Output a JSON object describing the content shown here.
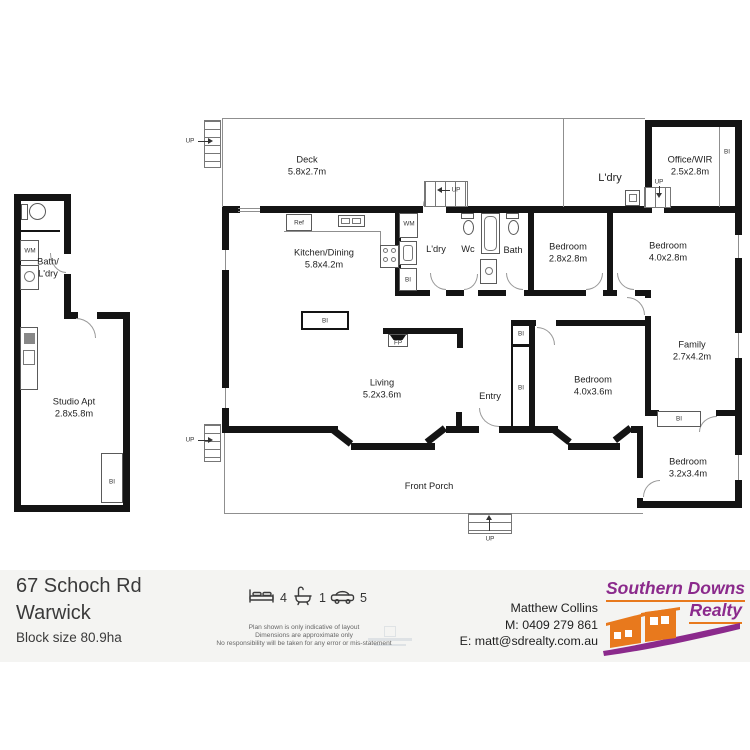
{
  "plan": {
    "rooms": {
      "deck": {
        "name": "Deck",
        "dims": "5.8x2.7m"
      },
      "ldry_top": {
        "name": "L'dry"
      },
      "office": {
        "name": "Office/WIR",
        "dims": "2.5x2.8m"
      },
      "kitchen": {
        "name": "Kitchen/Dining",
        "dims": "5.8x4.2m"
      },
      "ldry": {
        "name": "L'dry"
      },
      "wc": {
        "name": "Wc"
      },
      "bath": {
        "name": "Bath"
      },
      "bed1": {
        "name": "Bedroom",
        "dims": "2.8x2.8m"
      },
      "bed2": {
        "name": "Bedroom",
        "dims": "4.0x2.8m"
      },
      "living": {
        "name": "Living",
        "dims": "5.2x3.6m"
      },
      "entry": {
        "name": "Entry"
      },
      "bed3": {
        "name": "Bedroom",
        "dims": "4.0x3.6m"
      },
      "family": {
        "name": "Family",
        "dims": "2.7x4.2m"
      },
      "bed4": {
        "name": "Bedroom",
        "dims": "3.2x3.4m"
      },
      "porch": {
        "name": "Front Porch"
      },
      "bath_ldry": {
        "line1": "Bath/",
        "line2": "L'dry"
      },
      "studio": {
        "name": "Studio Apt",
        "dims": "2.8x5.8m"
      }
    },
    "tags": {
      "wm": "WM",
      "ref": "Ref",
      "bi": "BI",
      "fp": "FP",
      "up": "UP"
    }
  },
  "footer": {
    "address1": "67 Schoch Rd",
    "address2": "Warwick",
    "block": "Block size 80.9ha",
    "beds": "4",
    "baths": "1",
    "cars": "5",
    "disclaimer1": "Plan shown is only indicative of layout",
    "disclaimer2": "Dimensions are approximate only",
    "disclaimer3": "No responsibility will be taken for any error or mis-statement",
    "agent_name": "Matthew Collins",
    "agent_mobile": "M: 0409 279 861",
    "agent_email": "E: matt@sdrealty.com.au",
    "brand1": "Southern Downs",
    "brand2": "Realty",
    "colors": {
      "purple": "#8b2a8c",
      "orange": "#e8791d"
    }
  }
}
